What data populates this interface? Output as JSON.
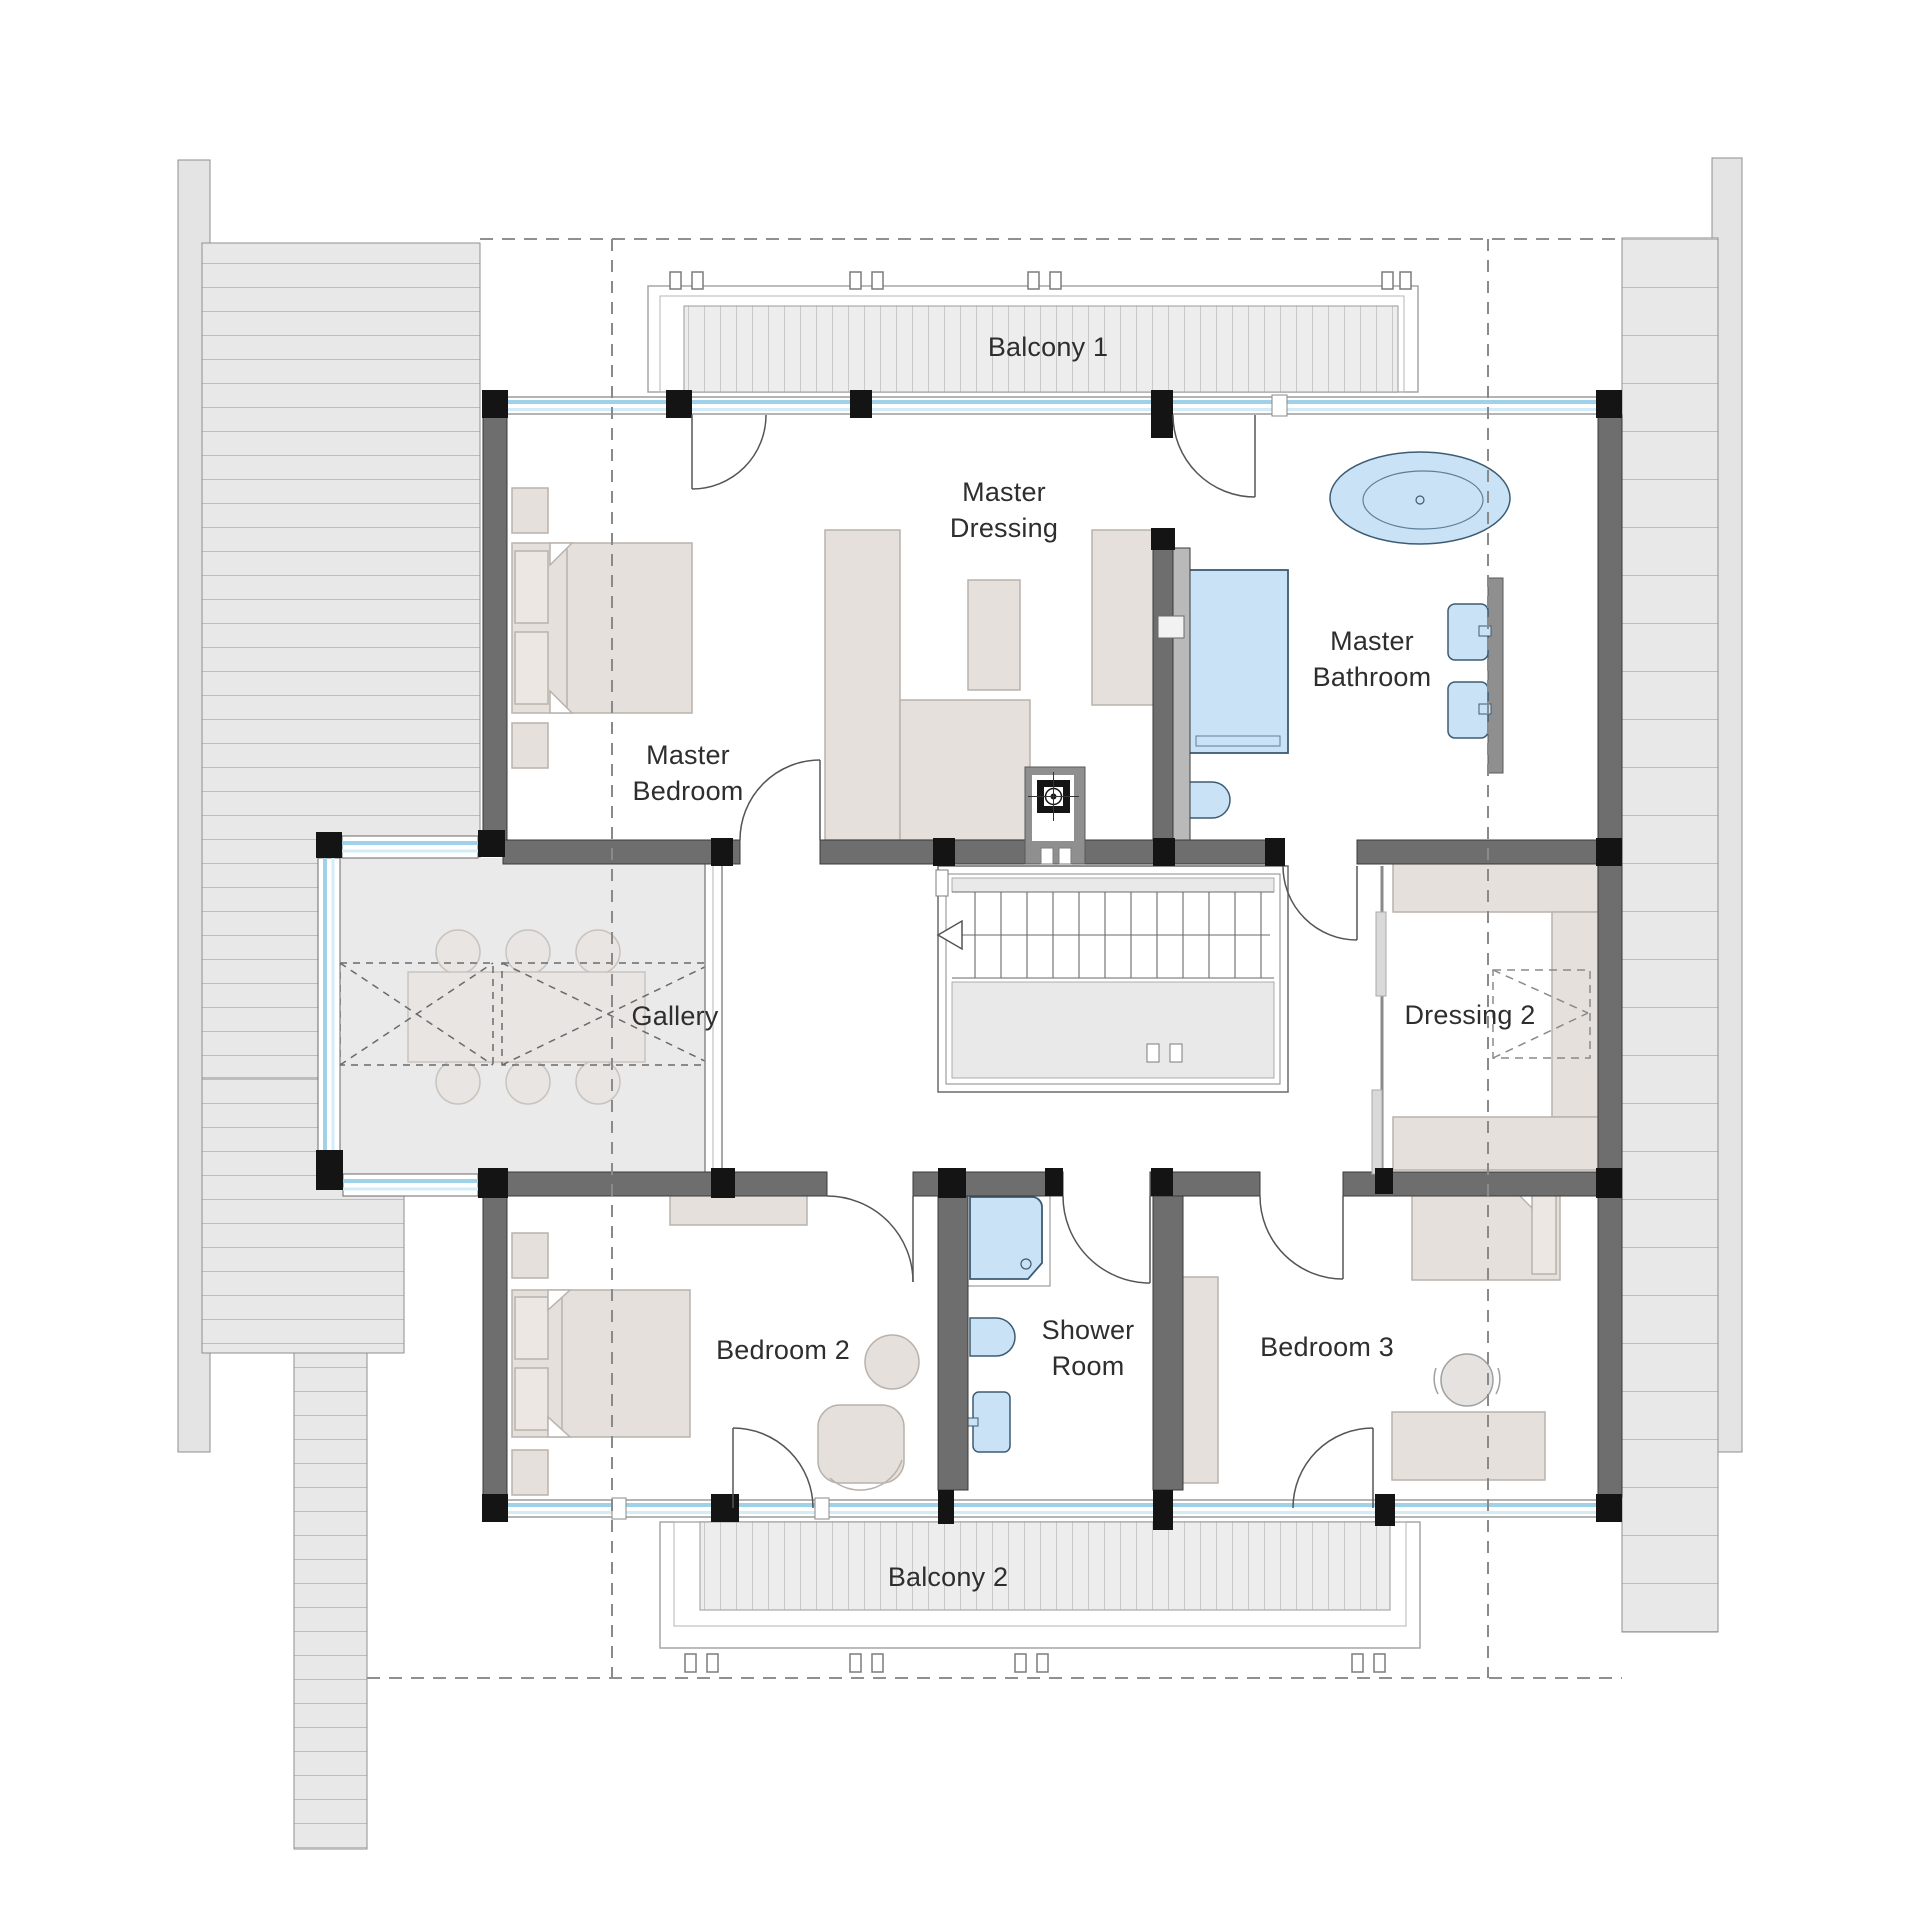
{
  "title": "Upper floor plan",
  "rooms": [
    {
      "id": "balcony-1",
      "label": "Balcony 1",
      "x": 1048,
      "y": 347
    },
    {
      "id": "master-dressing",
      "label": "Master\nDressing",
      "x": 1004,
      "y": 510
    },
    {
      "id": "master-bathroom",
      "label": "Master\nBathroom",
      "x": 1372,
      "y": 659
    },
    {
      "id": "master-bedroom",
      "label": "Master\nBedroom",
      "x": 688,
      "y": 773
    },
    {
      "id": "gallery",
      "label": "Gallery",
      "x": 675,
      "y": 1016
    },
    {
      "id": "dressing-2",
      "label": "Dressing 2",
      "x": 1470,
      "y": 1015
    },
    {
      "id": "bedroom-2",
      "label": "Bedroom 2",
      "x": 783,
      "y": 1350
    },
    {
      "id": "shower-room",
      "label": "Shower\nRoom",
      "x": 1088,
      "y": 1348
    },
    {
      "id": "bedroom-3",
      "label": "Bedroom 3",
      "x": 1327,
      "y": 1347
    },
    {
      "id": "balcony-2",
      "label": "Balcony 2",
      "x": 948,
      "y": 1577
    }
  ],
  "colors": {
    "wall_gray": "#6e6e6e",
    "post_black": "#141414",
    "window_blue": "#9fd2e8",
    "window_blue_light": "#d3ecf8",
    "fixture_blue": "#c9e2f6",
    "fixture_outline": "#3c5c74",
    "furniture_beige": "#e6e0dc",
    "furniture_outline": "#b9b2ac",
    "roof_gray": "#e8e8e8",
    "deck_gray": "#ededed",
    "floor_gray": "#eaeaea",
    "label_color": "#2e2e2e"
  }
}
